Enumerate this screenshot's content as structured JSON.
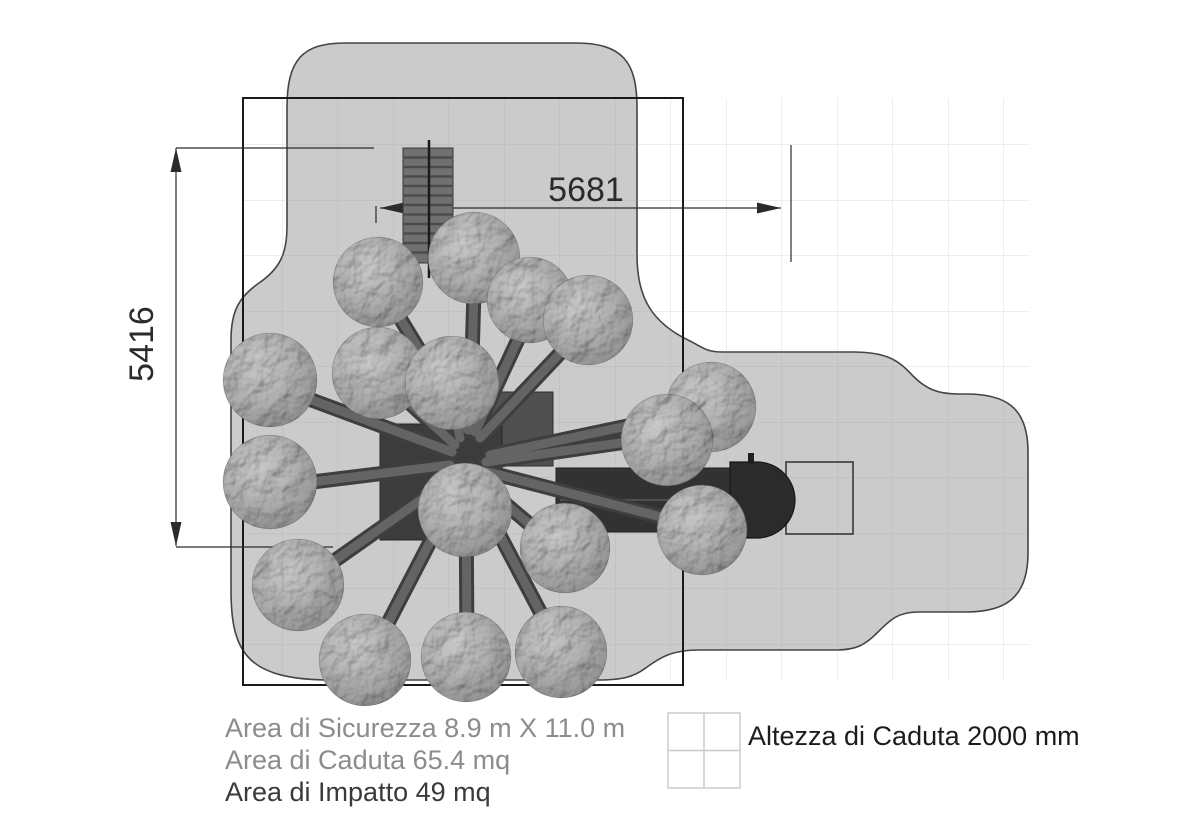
{
  "drawing": {
    "type": "playground-safety-area-plan",
    "dimensions": {
      "width_label": "5681",
      "height_label": "5416"
    },
    "legend": {
      "security_area": "Area di Sicurezza 8.9 m X 11.0 m",
      "fall_area": "Area di Caduta 65.4 mq",
      "impact_area": "Area di Impatto 49 mq",
      "fall_height": "Altezza di Caduta 2000 mm"
    },
    "icons": {
      "legend_swatch": "surface-grid-2x2"
    },
    "colors": {
      "safety_area_fill": "#cbcbcb",
      "safety_area_outline": "#444444",
      "boundary_rect_stroke": "#1a1a1a",
      "equipment_dark": "#303030",
      "ball_base": "#8f8f8f",
      "dimension_ink": "#2b2b2b",
      "legend_muted": "#8c8c8c",
      "legend_strong": "#3a3a3a",
      "grid_line": "#9a9a9a"
    }
  }
}
